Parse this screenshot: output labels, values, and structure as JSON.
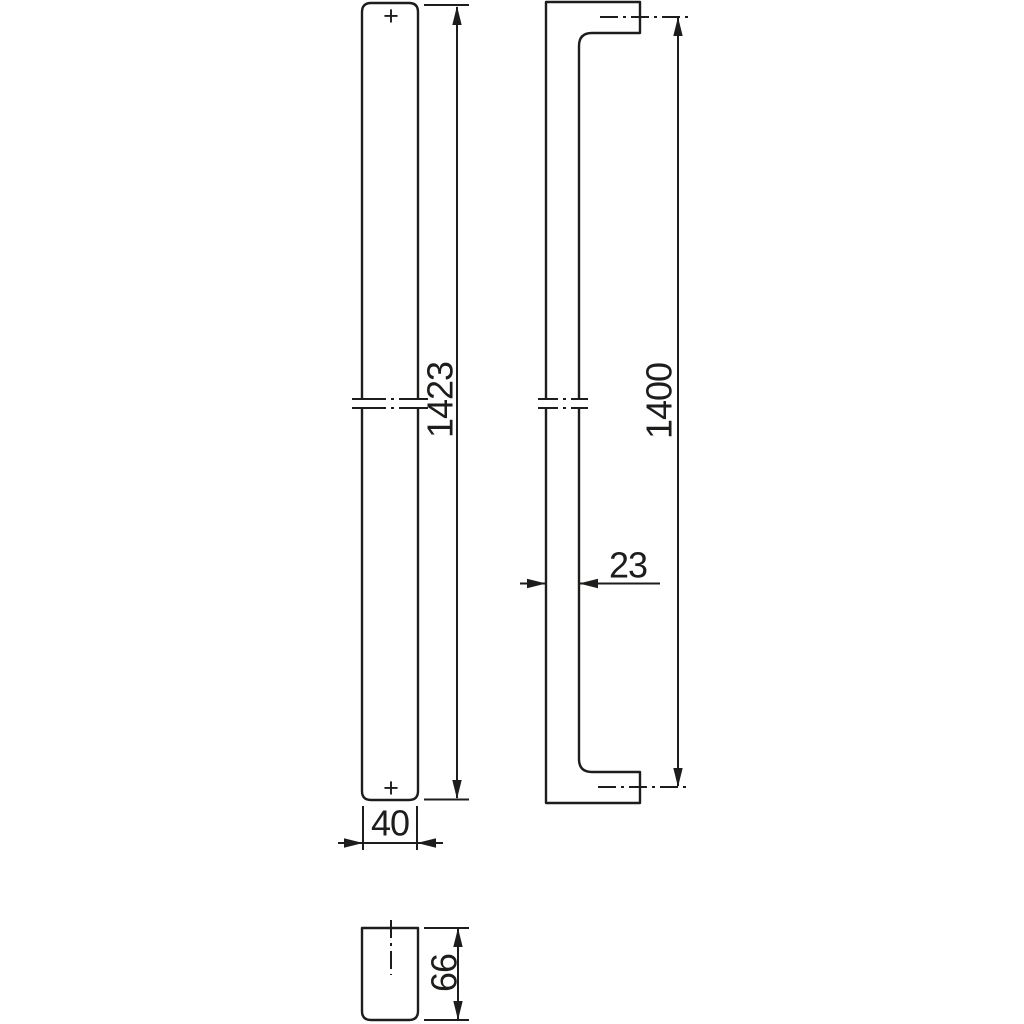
{
  "drawing": {
    "kind": "technical-drawing-door-pull-handle",
    "background_color": "#ffffff",
    "line_color": "#1d1d1b",
    "views": {
      "front": {
        "label": "front-view-bar-with-backplate",
        "marks": {
          "top": "+",
          "bottom": "+"
        }
      },
      "side": {
        "label": "side-profile-view"
      },
      "top": {
        "label": "top-section-view"
      }
    },
    "dimensions": {
      "overall_length": "1423",
      "hole_spacing": "1400",
      "grip_depth": "23",
      "bar_width": "40",
      "projection": "66"
    },
    "icons": {
      "front_top_mark": "plus-mark-icon",
      "front_bottom_mark": "plus-mark-icon"
    }
  }
}
